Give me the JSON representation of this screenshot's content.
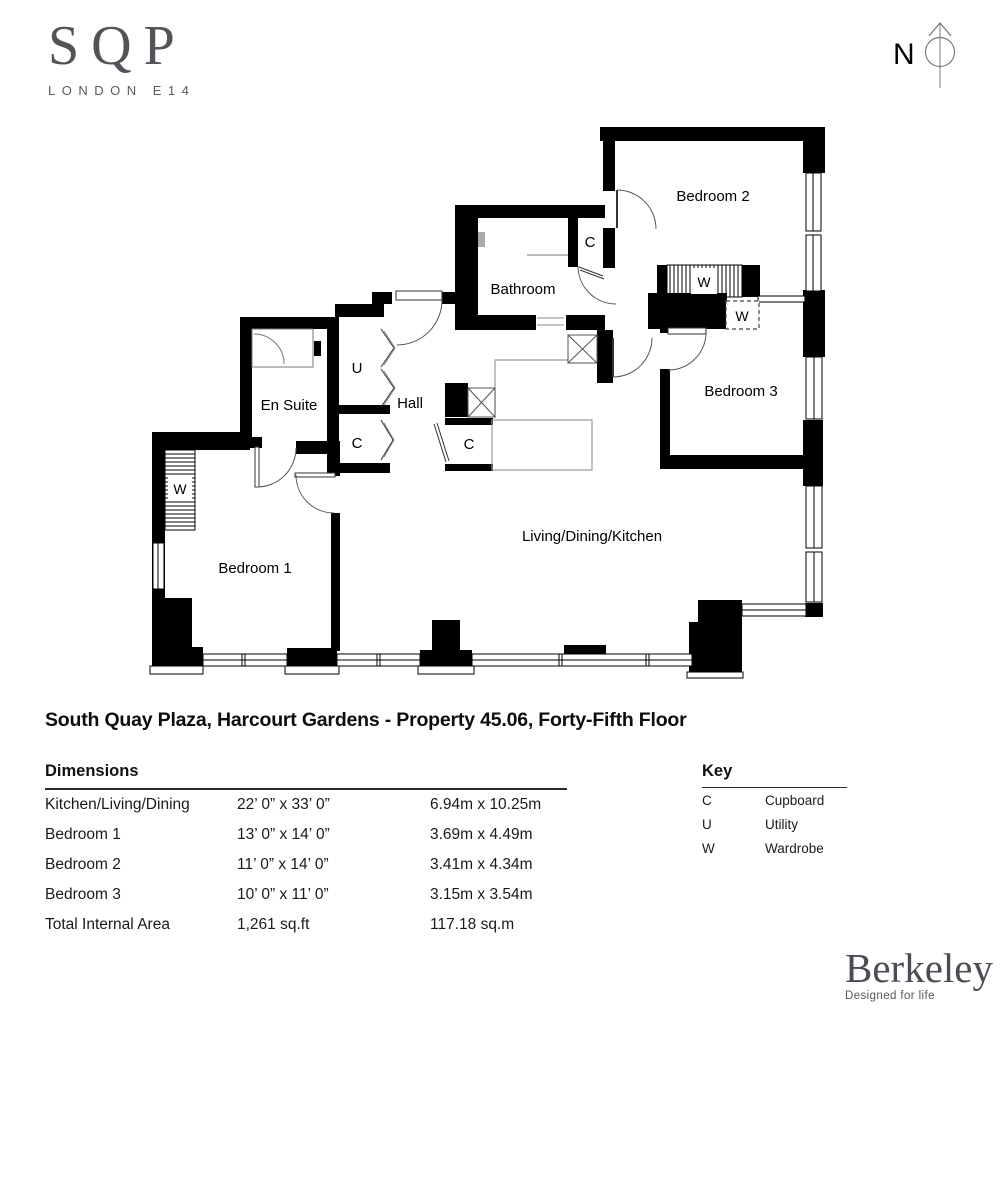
{
  "branding": {
    "logo_main": "SQP",
    "logo_sub": "LONDON E14"
  },
  "compass": {
    "label": "N"
  },
  "plan": {
    "rooms": {
      "bedroom2": "Bedroom 2",
      "bathroom": "Bathroom",
      "bedroom3": "Bedroom 3",
      "ensuite": "En Suite",
      "hall": "Hall",
      "bedroom1": "Bedroom 1",
      "living": "Living/Dining/Kitchen"
    },
    "symbols": {
      "cupboard": "C",
      "utility": "U",
      "wardrobe": "W"
    }
  },
  "title": "South Quay Plaza, Harcourt Gardens - Property 45.06, Forty-Fifth Floor",
  "dimensions": {
    "heading": "Dimensions",
    "rows": [
      {
        "label": "Kitchen/Living/Dining",
        "imperial": "22’ 0” x 33’ 0”",
        "metric": "6.94m x 10.25m"
      },
      {
        "label": "Bedroom 1",
        "imperial": "13’ 0” x 14’ 0”",
        "metric": "3.69m x 4.49m"
      },
      {
        "label": "Bedroom 2",
        "imperial": "11’ 0” x 14’ 0”",
        "metric": "3.41m x 4.34m"
      },
      {
        "label": "Bedroom 3",
        "imperial": "10’ 0” x 11’ 0”",
        "metric": "3.15m x 3.54m"
      },
      {
        "label": "Total Internal Area",
        "imperial": "1,261 sq.ft",
        "metric": "117.18 sq.m"
      }
    ]
  },
  "key": {
    "heading": "Key",
    "entries": [
      {
        "symbol": "C",
        "meaning": "Cupboard"
      },
      {
        "symbol": "U",
        "meaning": "Utility"
      },
      {
        "symbol": "W",
        "meaning": "Wardrobe"
      }
    ]
  },
  "developer": {
    "name": "Berkeley",
    "tagline": "Designed for life"
  }
}
